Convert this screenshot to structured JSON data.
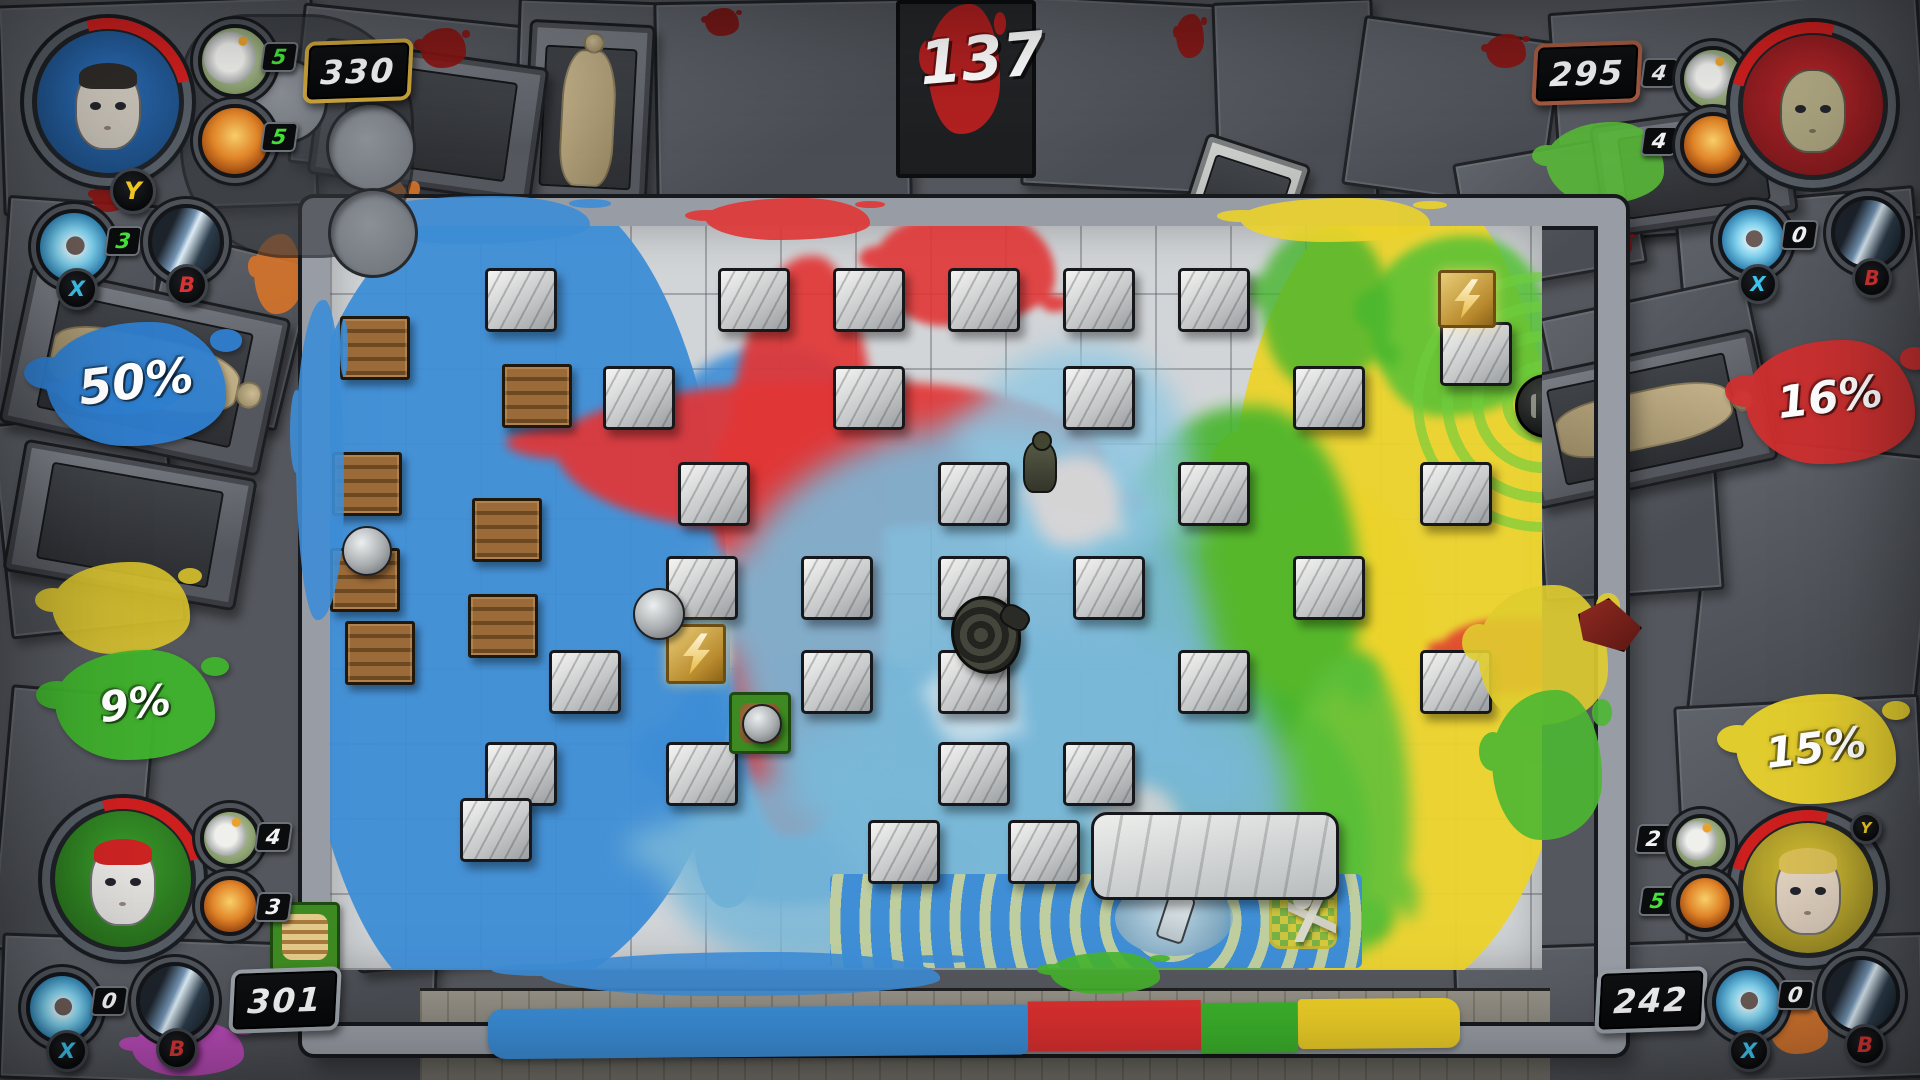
{
  "timer": {
    "value": "137"
  },
  "buttons": {
    "y": {
      "label": "Y",
      "color": "#f0c822"
    },
    "x": {
      "label": "X",
      "color": "#3ec1ea"
    },
    "b": {
      "label": "B",
      "color": "#d63434"
    }
  },
  "players": [
    {
      "corner": "top-left",
      "accent": "#2f7fd0",
      "portrait_bg": "#2a6db8",
      "hair": "#2e2a28",
      "skin": "#cfc9be",
      "percent": "50%",
      "score": "330",
      "plate_color": "#c9a23a",
      "bomb_count": "5",
      "bomb_count_color": "#45e03a",
      "power_count": "5",
      "power_count_color": "#45e03a",
      "ability_count": "3",
      "ability_count_color": "#45e03a"
    },
    {
      "corner": "top-right",
      "accent": "#d02f2f",
      "portrait_bg": "#b8252a",
      "hair": "rgba(0,0,0,0)",
      "skin": "#b5ad86",
      "percent": "16%",
      "score": "295",
      "plate_color": "#a55a40",
      "bomb_count": "4",
      "bomb_count_color": "#f2f2f2",
      "power_count": "4",
      "power_count_color": "#f2f2f2",
      "ability_count": "0",
      "ability_count_color": "#f2f2f2"
    },
    {
      "corner": "bottom-left",
      "accent": "#3fb32c",
      "portrait_bg": "#3a9e2a",
      "hair": "#cc2323",
      "skin": "#ecebe8",
      "percent": "9%",
      "score": "301",
      "plate_color": "#9aa0a8",
      "bomb_count": "4",
      "bomb_count_color": "#f2f2f2",
      "power_count": "3",
      "power_count_color": "#f2f2f2",
      "ability_count": "0",
      "ability_count_color": "#f2f2f2"
    },
    {
      "corner": "bottom-right",
      "accent": "#e9d22c",
      "portrait_bg": "#d9c435",
      "hair": "#d8bd55",
      "skin": "#e6d6c4",
      "percent": "15%",
      "score": "242",
      "plate_color": "#9aa0a8",
      "bomb_count": "2",
      "bomb_count_color": "#f2f2f2",
      "power_count": "5",
      "power_count_color": "#45e03a",
      "ability_count": "0",
      "ability_count_color": "#f2f2f2"
    }
  ],
  "coverage_bar": {
    "segments": [
      {
        "name": "blue",
        "color": "#3b8ed8",
        "pct": 50
      },
      {
        "name": "red",
        "color": "#dd3030",
        "pct": 16
      },
      {
        "name": "green",
        "color": "#3cb32c",
        "pct": 9
      },
      {
        "name": "yellow",
        "color": "#eed028",
        "pct": 15
      }
    ]
  },
  "arena": {
    "splats": [
      {
        "x": -40,
        "y": -40,
        "w": 440,
        "h": 820,
        "c": "#3d8dd6",
        "o": 0.95
      },
      {
        "x": 330,
        "y": 420,
        "w": 300,
        "h": 260,
        "c": "#3d8dd6",
        "b": 6,
        "o": 0.9
      },
      {
        "x": 340,
        "y": 120,
        "w": 200,
        "h": 180,
        "c": "#3d8dd6",
        "b": 6,
        "o": 0.9
      },
      {
        "x": 900,
        "y": -40,
        "w": 340,
        "h": 820,
        "c": "#ecd32b",
        "o": 0.95
      },
      {
        "x": 880,
        "y": 260,
        "w": 220,
        "h": 260,
        "c": "#ecd32b",
        "b": 6,
        "o": 0.9
      },
      {
        "x": 1040,
        "y": 10,
        "w": 180,
        "h": 180,
        "c": "#54c136",
        "b": 5,
        "o": 0.85
      },
      {
        "x": 790,
        "y": 180,
        "w": 240,
        "h": 340,
        "c": "#46b52c",
        "b": 8,
        "o": 0.9
      },
      {
        "x": 740,
        "y": 460,
        "w": 300,
        "h": 290,
        "c": "#46b52c",
        "b": 8,
        "o": 0.9
      },
      {
        "x": 930,
        "y": 0,
        "w": 130,
        "h": 160,
        "c": "#46b52c",
        "b": 6,
        "o": 0.8
      },
      {
        "x": 960,
        "y": 430,
        "w": 120,
        "h": 300,
        "c": "#5bc03a",
        "b": 8,
        "o": 0.85
      },
      {
        "x": 600,
        "y": 650,
        "w": 120,
        "h": 90,
        "c": "#46b52c",
        "b": 6,
        "o": 0.85
      },
      {
        "x": 395,
        "y": 30,
        "w": 160,
        "h": 580,
        "c": "#e23636",
        "b": 5,
        "o": 0.92
      },
      {
        "x": 225,
        "y": 155,
        "w": 550,
        "h": 150,
        "c": "#e23636",
        "b": 5,
        "o": 0.92
      },
      {
        "x": 545,
        "y": -15,
        "w": 180,
        "h": 115,
        "c": "#e23636",
        "b": 4,
        "o": 0.9
      },
      {
        "x": 1110,
        "y": 392,
        "w": 150,
        "h": 75,
        "c": "#e04430",
        "b": 4,
        "o": 0.9
      },
      {
        "x": 400,
        "y": 200,
        "w": 480,
        "h": 430,
        "c": "#7ab8d8",
        "b": 16,
        "o": 0.9
      },
      {
        "x": 500,
        "y": 400,
        "w": 460,
        "h": 330,
        "c": "#7ab8d8",
        "b": 16,
        "o": 0.92
      },
      {
        "x": 330,
        "y": 540,
        "w": 380,
        "h": 200,
        "c": "#7ab8d8",
        "b": 14,
        "o": 0.85
      },
      {
        "x": 640,
        "y": 120,
        "w": 220,
        "h": 220,
        "c": "#8ec7e2",
        "b": 14,
        "o": 0.8
      },
      {
        "x": 700,
        "y": 230,
        "w": 90,
        "h": 90,
        "c": "#e8d9d4",
        "b": 8,
        "o": 0.8
      },
      {
        "x": 600,
        "y": 430,
        "w": 90,
        "h": 90,
        "c": "#dfe8ee",
        "b": 8,
        "o": 0.7
      },
      {
        "x": 770,
        "y": 560,
        "w": 80,
        "h": 80,
        "c": "#e8d9d4",
        "b": 8,
        "o": 0.7
      }
    ],
    "blocks": [
      {
        "x": 155,
        "y": 42
      },
      {
        "x": 388,
        "y": 42
      },
      {
        "x": 503,
        "y": 42
      },
      {
        "x": 618,
        "y": 42
      },
      {
        "x": 733,
        "y": 42
      },
      {
        "x": 848,
        "y": 42
      },
      {
        "x": 1110,
        "y": 96
      },
      {
        "x": 273,
        "y": 140
      },
      {
        "x": 503,
        "y": 140
      },
      {
        "x": 733,
        "y": 140
      },
      {
        "x": 963,
        "y": 140
      },
      {
        "x": 348,
        "y": 236
      },
      {
        "x": 608,
        "y": 236
      },
      {
        "x": 848,
        "y": 236
      },
      {
        "x": 1090,
        "y": 236
      },
      {
        "x": 336,
        "y": 330
      },
      {
        "x": 471,
        "y": 330
      },
      {
        "x": 608,
        "y": 330
      },
      {
        "x": 743,
        "y": 330
      },
      {
        "x": 963,
        "y": 330
      },
      {
        "x": 219,
        "y": 424
      },
      {
        "x": 471,
        "y": 424
      },
      {
        "x": 608,
        "y": 424
      },
      {
        "x": 848,
        "y": 424
      },
      {
        "x": 1090,
        "y": 424
      },
      {
        "x": 155,
        "y": 516
      },
      {
        "x": 336,
        "y": 516
      },
      {
        "x": 608,
        "y": 516
      },
      {
        "x": 733,
        "y": 516
      },
      {
        "x": 130,
        "y": 572
      },
      {
        "x": 538,
        "y": 594
      },
      {
        "x": 678,
        "y": 594
      },
      {
        "x": 761,
        "y": 586,
        "w": 242,
        "h": 82,
        "t": "slab"
      }
    ],
    "crates": [
      {
        "x": 10,
        "y": 90
      },
      {
        "x": 172,
        "y": 138
      },
      {
        "x": 2,
        "y": 226
      },
      {
        "x": 142,
        "y": 272
      },
      {
        "x": 0,
        "y": 322
      },
      {
        "x": 138,
        "y": 368
      },
      {
        "x": 15,
        "y": 395
      }
    ],
    "items": [
      {
        "t": "lightning",
        "x": 336,
        "y": 398,
        "s": 54
      },
      {
        "t": "lightning",
        "x": 1108,
        "y": 44,
        "s": 52
      },
      {
        "t": "bomb",
        "x": 1185,
        "y": 148,
        "s": 58
      },
      {
        "t": "rock",
        "x": 12,
        "y": 300,
        "s": 46
      },
      {
        "t": "rock",
        "x": 303,
        "y": 362,
        "s": 48
      },
      {
        "t": "rocktile",
        "x": 399,
        "y": 466,
        "s": 56
      }
    ],
    "chars": [
      {
        "t": "soldier",
        "x": 693,
        "y": 215,
        "w": 30,
        "h": 48
      },
      {
        "t": "backpack",
        "x": 621,
        "y": 370,
        "w": 64,
        "h": 72
      }
    ],
    "corner_rings": {
      "x": 1083,
      "y": 46,
      "s": 260,
      "color": "rgba(110,205,60,.65)"
    },
    "lane": {
      "x": 500,
      "y": 648,
      "w": 532,
      "h": 94,
      "base": "#3f8ed6",
      "ring": "rgba(234,228,142,.75)",
      "water": {
        "x": 285,
        "y": 6,
        "w": 118,
        "h": 76
      },
      "bottle": {
        "x": 332,
        "y": 18
      },
      "checker": {
        "x": 442,
        "y": 10,
        "s": 62
      },
      "skeleton": {
        "x": 458,
        "y": 14,
        "w": 48,
        "h": 54
      }
    }
  },
  "environment": {
    "panels": [
      {
        "x": 0,
        "y": 0,
        "w": 310,
        "h": 205,
        "r": -2
      },
      {
        "x": 295,
        "y": 15,
        "w": 245,
        "h": 155,
        "r": 6
      },
      {
        "x": 515,
        "y": 0,
        "w": 145,
        "h": 215,
        "r": 2
      },
      {
        "x": 655,
        "y": 0,
        "w": 250,
        "h": 195,
        "r": -1
      },
      {
        "x": 1025,
        "y": 0,
        "w": 205,
        "h": 185,
        "r": 3
      },
      {
        "x": 1215,
        "y": 0,
        "w": 155,
        "h": 205,
        "r": -2
      },
      {
        "x": 1352,
        "y": 28,
        "w": 195,
        "h": 165,
        "r": 8
      },
      {
        "x": 1555,
        "y": 0,
        "w": 365,
        "h": 225,
        "r": -4
      },
      {
        "x": 1462,
        "y": 148,
        "w": 170,
        "h": 125,
        "r": -10
      },
      {
        "x": 0,
        "y": 200,
        "w": 150,
        "h": 230,
        "r": 4
      },
      {
        "x": 0,
        "y": 415,
        "w": 170,
        "h": 210,
        "r": -6
      },
      {
        "x": 148,
        "y": 245,
        "w": 145,
        "h": 165,
        "r": 14
      },
      {
        "x": 0,
        "y": 690,
        "w": 140,
        "h": 260,
        "r": 5
      },
      {
        "x": 1685,
        "y": 195,
        "w": 235,
        "h": 270,
        "r": -5
      },
      {
        "x": 1556,
        "y": 295,
        "w": 205,
        "h": 185,
        "r": -12
      },
      {
        "x": 1698,
        "y": 445,
        "w": 222,
        "h": 310,
        "r": 6
      },
      {
        "x": 1538,
        "y": 425,
        "w": 175,
        "h": 165,
        "r": -4
      },
      {
        "x": 1680,
        "y": 700,
        "w": 240,
        "h": 260,
        "r": -3
      },
      {
        "x": 0,
        "y": 940,
        "w": 430,
        "h": 140,
        "r": 2
      },
      {
        "x": 1455,
        "y": 940,
        "w": 465,
        "h": 140,
        "r": -2
      }
    ],
    "tables": [
      {
        "x": 525,
        "y": 22,
        "w": 120,
        "h": 185,
        "r": 3,
        "body": true
      },
      {
        "x": 315,
        "y": 52,
        "w": 220,
        "h": 132,
        "r": 8
      },
      {
        "x": 12,
        "y": 290,
        "w": 260,
        "h": 155,
        "r": 12,
        "body": true
      },
      {
        "x": 12,
        "y": 458,
        "w": 230,
        "h": 128,
        "r": 10
      },
      {
        "x": 1522,
        "y": 352,
        "w": 240,
        "h": 128,
        "r": -12,
        "body": true
      },
      {
        "x": 1596,
        "y": 112,
        "w": 190,
        "h": 108,
        "r": -8
      },
      {
        "x": 350,
        "y": 832,
        "w": 155,
        "h": 128,
        "r": -6
      },
      {
        "x": 1185,
        "y": 146,
        "w": 104,
        "h": 122,
        "r": 18,
        "light": true
      }
    ],
    "splats": [
      {
        "x": 420,
        "y": 28,
        "w": 46,
        "h": 40,
        "c": "#8a1412"
      },
      {
        "x": 92,
        "y": 182,
        "w": 34,
        "h": 30,
        "c": "#8a1412"
      },
      {
        "x": 1486,
        "y": 34,
        "w": 40,
        "h": 34,
        "c": "#8a1412"
      },
      {
        "x": 1602,
        "y": 232,
        "w": 30,
        "h": 26,
        "c": "#8a1412"
      },
      {
        "x": 1176,
        "y": 14,
        "w": 28,
        "h": 44,
        "c": "#8a1412"
      },
      {
        "x": 705,
        "y": 8,
        "w": 34,
        "h": 28,
        "c": "#7a1210"
      },
      {
        "x": 350,
        "y": 176,
        "w": 64,
        "h": 88,
        "c": "#d8742a"
      },
      {
        "x": 254,
        "y": 234,
        "w": 48,
        "h": 80,
        "c": "#d8742a"
      },
      {
        "x": 1770,
        "y": 1008,
        "w": 58,
        "h": 46,
        "c": "#d8742a"
      },
      {
        "x": 1546,
        "y": 122,
        "w": 118,
        "h": 82,
        "c": "#58b838"
      },
      {
        "x": 52,
        "y": 562,
        "w": 138,
        "h": 92,
        "c": "#d8c22c"
      },
      {
        "x": 58,
        "y": 368,
        "w": 122,
        "h": 46,
        "c": "#2f7fd0"
      }
    ],
    "overlay_splats": [
      {
        "x": 360,
        "y": 196,
        "w": 230,
        "h": 48,
        "c": "#3d8dd6"
      },
      {
        "x": 705,
        "y": 198,
        "w": 165,
        "h": 42,
        "c": "#e23636"
      },
      {
        "x": 1240,
        "y": 198,
        "w": 190,
        "h": 44,
        "c": "#ecd32b"
      },
      {
        "x": 540,
        "y": 952,
        "w": 400,
        "h": 44,
        "c": "#3d8dd6"
      },
      {
        "x": 1050,
        "y": 952,
        "w": 110,
        "h": 42,
        "c": "#46b52c"
      },
      {
        "x": 296,
        "y": 300,
        "w": 48,
        "h": 320,
        "c": "#3d8dd6"
      },
      {
        "x": 1478,
        "y": 585,
        "w": 130,
        "h": 140,
        "c": "#e0cd2e"
      },
      {
        "x": 1492,
        "y": 690,
        "w": 110,
        "h": 150,
        "c": "#4cb832"
      },
      {
        "x": 132,
        "y": 1022,
        "w": 112,
        "h": 54,
        "c": "#c24ac0"
      }
    ],
    "overlay_items": [
      {
        "t": "burger",
        "x": 270,
        "y": 902,
        "s": 64
      },
      {
        "t": "redhood",
        "x": 1578,
        "y": 598,
        "w": 60,
        "h": 50
      }
    ],
    "door": {
      "x": 896,
      "y": 0,
      "w": 132,
      "h": 170,
      "blood": {
        "x": 28,
        "y": 0,
        "w": 72,
        "h": 130,
        "c": "#c32020"
      }
    }
  }
}
